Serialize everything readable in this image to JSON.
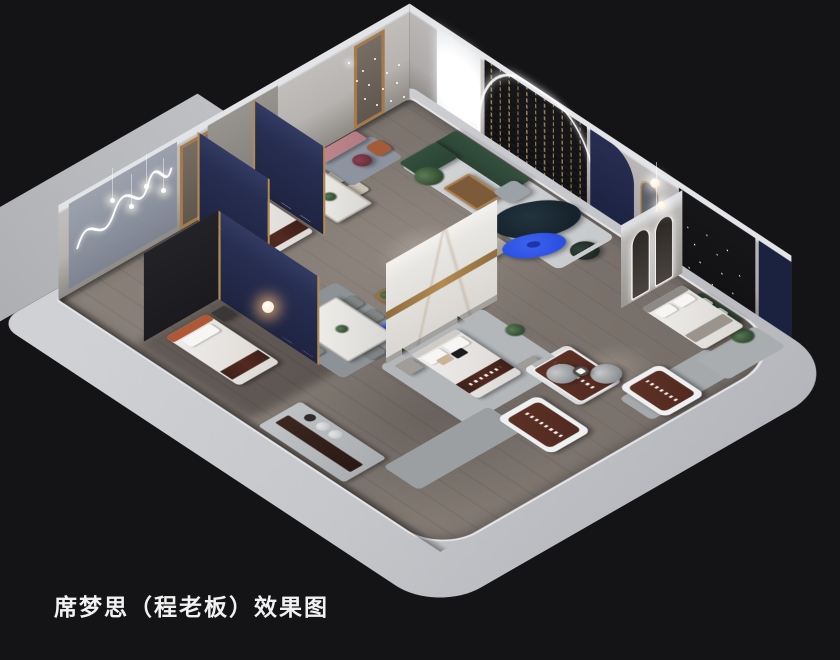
{
  "caption": {
    "text": "席梦思（程老板）效果图"
  },
  "palette": {
    "background": "#141417",
    "caption_color": "#f1f1f1",
    "outer_wall": "#c6c7cb",
    "wall_top_edge": "#e3e4e7",
    "apron": "#b7b8bc",
    "inner_wall": "#b2afac",
    "floor": "#837a74",
    "rug_light": "#c7cacc",
    "rug_blue_gray": "#8d94a0",
    "accent_blue": "#2b4fdf",
    "sofa_green": "#33503d",
    "sofa_teal": "#16232c",
    "bench_pink": "#b07a80",
    "mattress_brown": "#532a20",
    "brass": "#b28a52",
    "navy_panel": "#272e52",
    "marble": "#e8e6e2",
    "feature_dark": "#17171a"
  }
}
